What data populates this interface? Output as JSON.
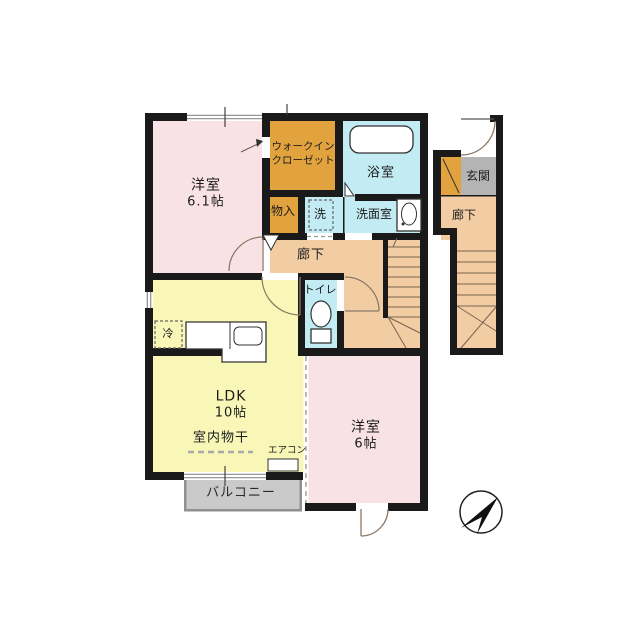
{
  "colors": {
    "wall": "#1a1a1a",
    "bedroom_pink": "#f8e2e6",
    "ldk_yellow": "#f8f7b8",
    "closet_orange": "#e2a33e",
    "wet_cyan": "#c2ebf3",
    "hall_tan": "#f2cda4",
    "entrance_gray": "#b4b4b4",
    "balcony_gray": "#cacaca",
    "line_brown": "#8c7a68"
  },
  "rooms": {
    "bedroom_1": {
      "name": "洋室",
      "size": "6.1帖"
    },
    "walk_in_closet": {
      "line1": "ウォークイン",
      "line2": "クローゼット"
    },
    "bathroom": {
      "name": "浴室"
    },
    "storage": {
      "name": "物入"
    },
    "laundry": {
      "name": "洗"
    },
    "washroom": {
      "name": "洗面室"
    },
    "hallway_2f": {
      "name": "廊下"
    },
    "toilet": {
      "name": "トイレ"
    },
    "ldk": {
      "name": "LDK",
      "size": "10帖"
    },
    "refrigerator": {
      "name": "冷"
    },
    "indoor_drying": {
      "name": "室内物干"
    },
    "air_conditioner": {
      "name": "エアコン"
    },
    "balcony": {
      "name": "バルコニー"
    },
    "bedroom_2": {
      "name": "洋室",
      "size": "6帖"
    },
    "entrance": {
      "name": "玄関"
    },
    "hallway_1f": {
      "name": "廊下"
    }
  }
}
